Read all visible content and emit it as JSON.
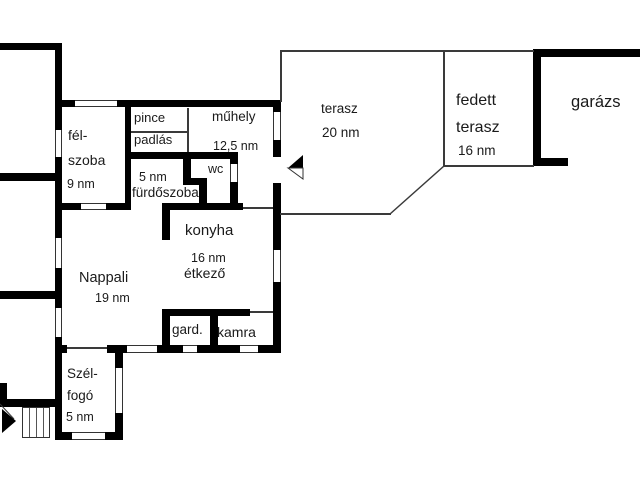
{
  "title": "house floor plan",
  "rooms": {
    "felszoba": {
      "l1": "fél-",
      "l2": "szoba",
      "area": "9 nm"
    },
    "pince": {
      "l1": "pince"
    },
    "padlas": {
      "l1": "padlás"
    },
    "muhely": {
      "l1": "műhely",
      "area": "12,5 nm"
    },
    "wc": {
      "l1": "wc"
    },
    "furdoszoba": {
      "l1": "fürdőszoba",
      "area": "5 nm"
    },
    "konyha": {
      "l1": "konyha",
      "l2": "étkező",
      "area": "16 nm"
    },
    "nappali": {
      "l1": "Nappali",
      "area": "19 nm"
    },
    "gardrob": {
      "l1": "gard."
    },
    "kamra": {
      "l1": "kamra"
    },
    "szelfogo": {
      "l1": "Szél-",
      "l2": "fogó",
      "area": "5 nm"
    },
    "terasz": {
      "l1": "terasz",
      "area": "20 nm"
    },
    "fedett_terasz": {
      "l1": "fedett",
      "l2": "terasz",
      "area": "16 nm"
    },
    "garazs": {
      "l1": "garázs"
    }
  },
  "colors": {
    "wall": "#000000",
    "thin_line": "#3a3a3a",
    "text": "#1a1a1a",
    "background": "#ffffff"
  }
}
